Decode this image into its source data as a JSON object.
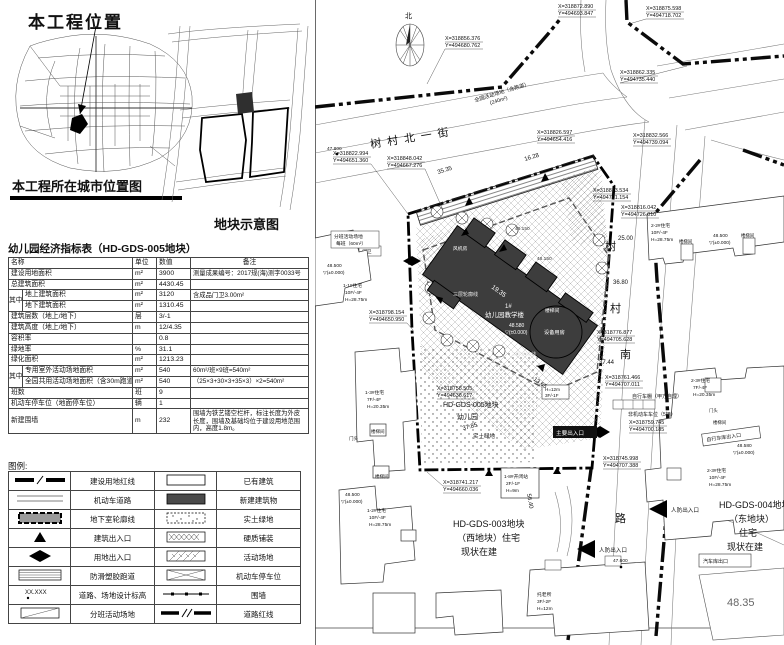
{
  "left": {
    "location_title": "本工程位置",
    "city_caption": "本工程所在城市位置图",
    "plot_caption": "地块示意图",
    "table": {
      "title": "幼儿园经济指标表（HD-GDS-005地块）",
      "headers": {
        "name": "名称",
        "unit": "单位",
        "value": "数值",
        "note": "备注"
      },
      "group_label": "其中",
      "rows": [
        {
          "name": "建设用地面积",
          "unit": "m²",
          "value": "3900",
          "note": "测量成果编号：2017规(海)测字0033号"
        },
        {
          "name": "总建筑面积",
          "unit": "m²",
          "value": "4430.45",
          "note": ""
        },
        {
          "name": "地上建筑面积",
          "unit": "m²",
          "value": "3120",
          "note": "含成品门卫3.00m²"
        },
        {
          "name": "地下建筑面积",
          "unit": "m²",
          "value": "1310.45",
          "note": ""
        },
        {
          "name": "建筑层数（地上/地下）",
          "unit": "层",
          "value": "3/-1",
          "note": ""
        },
        {
          "name": "建筑高度（地上/地下）",
          "unit": "m",
          "value": "12/4.35",
          "note": ""
        },
        {
          "name": "容积率",
          "unit": "",
          "value": "0.8",
          "note": ""
        },
        {
          "name": "绿地率",
          "unit": "%",
          "value": "31.1",
          "note": ""
        },
        {
          "name": "绿化面积",
          "unit": "m²",
          "value": "1213.23",
          "note": ""
        },
        {
          "name": "专用室外活动场地面积",
          "unit": "m²",
          "value": "540",
          "note": "60m²/班×9班=540m²"
        },
        {
          "name": "全园共用活动场地面积（含30m跑道）",
          "unit": "m²",
          "value": "540",
          "note": "（25×3+30×3+35×3）×2=540m²"
        },
        {
          "name": "班数",
          "unit": "班",
          "value": "9",
          "note": ""
        },
        {
          "name": "机动车停车位（地面停车位）",
          "unit": "辆",
          "value": "1",
          "note": ""
        },
        {
          "name": "新建围墙",
          "unit": "m",
          "value": "232",
          "note": "围墙为铁艺镂空栏杆，标注长度为外皮长度，围墙及基础均位于建设用地范围内，高度1.8m。"
        }
      ]
    },
    "legend": {
      "title": "图例:",
      "elev_symbol": "XX.XXX",
      "left": [
        "建设用地红线",
        "机动车道路",
        "地下室轮廓线",
        "建筑出入口",
        "用地出入口",
        "防滑塑胶跑道",
        "道路、场地设计标高",
        "分班活动场地"
      ],
      "right": [
        "已有建筑",
        "新建建筑物",
        "实土绿地",
        "硬质铺装",
        "活动场地",
        "机动车停车位",
        "围墙",
        "道路红线"
      ]
    }
  },
  "plan": {
    "north": "北",
    "street_north": "树村北一街",
    "street_south": {
      "c1": "树",
      "c2": "村",
      "c3": "南",
      "c4": "路"
    },
    "site": {
      "plot": "HD-GDS-005地块",
      "use": "幼儿园"
    },
    "west_plot": {
      "l1": "HD-GDS-003地块",
      "l2": "（西地块）住宅",
      "l3": "现状在建"
    },
    "east_plot": {
      "l1": "HD-GDS-004地块",
      "l2": "（东地块）",
      "l3": "住宅",
      "l4": "现状在建"
    },
    "building": {
      "no": "1#",
      "name": "幼儿园教学楼",
      "outline3f": "三层轮廓线",
      "fan": "风机房",
      "equip": "设备用房",
      "hbox1": "H=12m",
      "hbox2": "3F/-1F"
    },
    "labels": {
      "runway": "全园活动场地（含跑道）",
      "runway2": "(240m²)",
      "class_area": "分班活动场地",
      "class_area2": "每班（60m²）",
      "green": "实土绿地",
      "main_entry": "主要出入口",
      "civil_entry": "人防出入口",
      "garage_exit": "汽车库出口",
      "bike_entry": "自行车库出入口",
      "bike_shed": "自行车棚（甲方自理）",
      "moto_parking": "非机动车车位（5辆）",
      "guard": "门卫",
      "stair": "楼梯间",
      "door": "门头",
      "elev485": "48.500",
      "elev4858": "48.580",
      "elev_base": "▽(±0.000)",
      "elev48150": "48.150",
      "spot1": "47.800",
      "spot2": "47.600",
      "corner_elev": "48.35",
      "kz1": "1-8#开闭站",
      "kz2": "2F/-1F",
      "kz3": "H=9m",
      "tl1": "托老所",
      "tl2": "3F/-2F",
      "tl3": "H=12m"
    },
    "res": {
      "r11": {
        "l1": "1-1#住宅",
        "l2": "10F/-4F",
        "l3": "H=28.75m"
      },
      "r12": {
        "l1": "1-2#住宅",
        "l2": "10F/-4F",
        "l3": "H=28.75m"
      },
      "r13": {
        "l1": "1-3#住宅",
        "l2": "7F/-4F",
        "l3": "H=20.35m"
      },
      "r22": {
        "l1": "2-2#住宅",
        "l2": "10F/-4F",
        "l3": "H=28.75m"
      },
      "r23a": {
        "l1": "2-3#住宅",
        "l2": "7F/-4F",
        "l3": "H=20.35m"
      },
      "r23b": {
        "l1": "2-3#住宅",
        "l2": "10F/-4F",
        "l3": "H=28.75m"
      }
    },
    "dims": {
      "d1": "35.35",
      "d2": "16.28",
      "d3": "25.00",
      "d4": "36.80",
      "d5": "37.44",
      "d6": "19.35",
      "d7": "13.65",
      "d8": "37.85",
      "d9": "56.40"
    },
    "coords": [
      {
        "x": "X=318856.376",
        "y": "Y=494680.762"
      },
      {
        "x": "X=318872.890",
        "y": "Y=494693.847"
      },
      {
        "x": "X=318875.598",
        "y": "Y=494718.702"
      },
      {
        "x": "X=318862.335",
        "y": "Y=494735.440"
      },
      {
        "x": "X=318832.566",
        "y": "Y=494739.094"
      },
      {
        "x": "X=318826.597",
        "y": "Y=494654.416"
      },
      {
        "x": "X=318848.042",
        "y": "Y=494667.276"
      },
      {
        "x": "X=318822.994",
        "y": "Y=494651.360"
      },
      {
        "x": "X=318813.534",
        "y": "Y=494701.154"
      },
      {
        "x": "X=318816.042",
        "y": "Y=494726.010"
      },
      {
        "x": "X=318798.154",
        "y": "Y=494650.950"
      },
      {
        "x": "X=318776.877",
        "y": "Y=494705.628"
      },
      {
        "x": "X=318761.466",
        "y": "Y=494707.011"
      },
      {
        "x": "X=318759.745",
        "y": "Y=494700.185"
      },
      {
        "x": "X=318745.998",
        "y": "Y=494707.388"
      },
      {
        "x": "X=318758.505",
        "y": "Y=494636.617"
      },
      {
        "x": "X=318741.217",
        "y": "Y=494660.036"
      }
    ]
  }
}
